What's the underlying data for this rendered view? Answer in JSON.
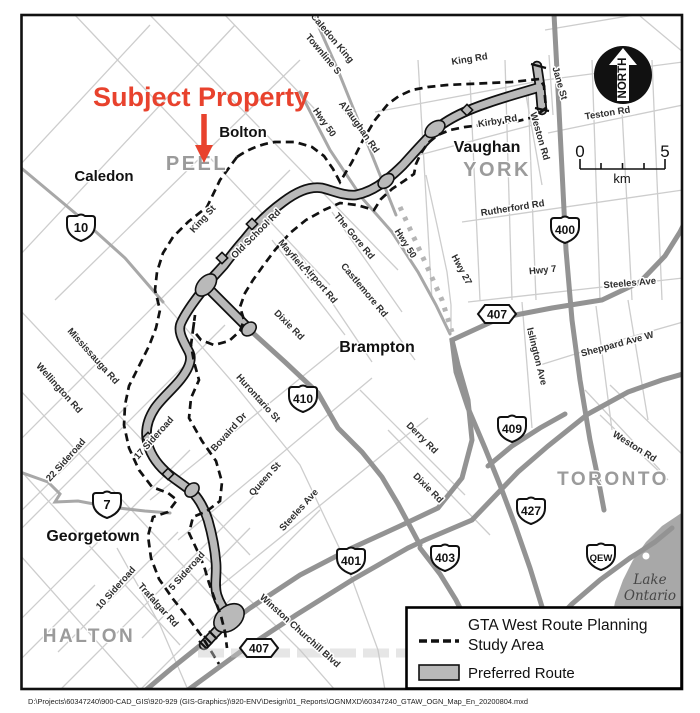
{
  "annotation": {
    "subject_property": "Subject Property",
    "color": "#e8422d"
  },
  "north_arrow": {
    "label": "NORTH"
  },
  "scale_bar": {
    "start": "0",
    "end": "5",
    "unit": "km"
  },
  "legend": {
    "study_area_line1": "GTA West Route Planning",
    "study_area_line2": "Study Area",
    "preferred_route": "Preferred Route"
  },
  "water": {
    "line1": "Lake",
    "line2": "Ontario"
  },
  "file_path": "D:\\Projects\\60347240\\900-CAD_GIS\\920-929 (GIS-Graphics)\\920-ENV\\Design\\01_Reports\\OGNMXD\\60347240_GTAW_OGN_Map_En_20200804.mxd",
  "regions": [
    {
      "name": "PEEL",
      "x": 197,
      "y": 170,
      "size": 20
    },
    {
      "name": "YORK",
      "x": 497,
      "y": 176,
      "size": 20
    },
    {
      "name": "TORONTO",
      "x": 613,
      "y": 485,
      "size": 19
    },
    {
      "name": "HALTON",
      "x": 89,
      "y": 642,
      "size": 19
    }
  ],
  "cities": [
    {
      "name": "Caledon",
      "x": 104,
      "y": 181,
      "size": 15
    },
    {
      "name": "Bolton",
      "x": 243,
      "y": 137,
      "size": 15
    },
    {
      "name": "Vaughan",
      "x": 487,
      "y": 152,
      "size": 16
    },
    {
      "name": "Brampton",
      "x": 377,
      "y": 352,
      "size": 16
    },
    {
      "name": "Georgetown",
      "x": 93,
      "y": 541,
      "size": 16
    }
  ],
  "road_labels": [
    {
      "t": "Caledon King",
      "x": 330,
      "y": 40,
      "r": 50
    },
    {
      "t": "Townline S",
      "x": 321,
      "y": 56,
      "r": 50
    },
    {
      "t": "Hwy 50",
      "x": 322,
      "y": 124,
      "r": 55
    },
    {
      "t": "Albion",
      "x": 347,
      "y": 116,
      "r": 55
    },
    {
      "t": "Vaughan Rd",
      "x": 359,
      "y": 131,
      "r": 55
    },
    {
      "t": "King Rd",
      "x": 470,
      "y": 62,
      "r": -9
    },
    {
      "t": "Jane St",
      "x": 557,
      "y": 84,
      "r": 74
    },
    {
      "t": "Weston Rd",
      "x": 537,
      "y": 137,
      "r": 74
    },
    {
      "t": "Teston Rd",
      "x": 608,
      "y": 116,
      "r": -9
    },
    {
      "t": "Kirby Rd",
      "x": 498,
      "y": 124,
      "r": -9
    },
    {
      "t": "Rutherford Rd",
      "x": 513,
      "y": 211,
      "r": -9
    },
    {
      "t": "Hwy 7",
      "x": 543,
      "y": 273,
      "r": -6
    },
    {
      "t": "Steeles Ave",
      "x": 630,
      "y": 286,
      "r": -5
    },
    {
      "t": "Sheppard Ave W",
      "x": 618,
      "y": 347,
      "r": -15
    },
    {
      "t": "Islington Ave",
      "x": 534,
      "y": 357,
      "r": 76
    },
    {
      "t": "Weston Rd",
      "x": 633,
      "y": 449,
      "r": 32
    },
    {
      "t": "Hwy 27",
      "x": 459,
      "y": 271,
      "r": 62
    },
    {
      "t": "Hwy 50",
      "x": 403,
      "y": 245,
      "r": 58
    },
    {
      "t": "King St",
      "x": 205,
      "y": 221,
      "r": -48
    },
    {
      "t": "Old School Rd",
      "x": 258,
      "y": 236,
      "r": -45
    },
    {
      "t": "The Gore Rd",
      "x": 352,
      "y": 238,
      "r": 50
    },
    {
      "t": "Mayfield Rd",
      "x": 295,
      "y": 263,
      "r": 50
    },
    {
      "t": "Airport Rd",
      "x": 318,
      "y": 286,
      "r": 50
    },
    {
      "t": "Castlemore Rd",
      "x": 362,
      "y": 292,
      "r": 50
    },
    {
      "t": "Dixie Rd",
      "x": 287,
      "y": 327,
      "r": 45
    },
    {
      "t": "Hurontario St",
      "x": 256,
      "y": 400,
      "r": 48
    },
    {
      "t": "Mississauga Rd",
      "x": 91,
      "y": 358,
      "r": 48
    },
    {
      "t": "Wellington Rd",
      "x": 57,
      "y": 390,
      "r": 48
    },
    {
      "t": "Bovaird Dr",
      "x": 231,
      "y": 434,
      "r": -48
    },
    {
      "t": "Queen St",
      "x": 267,
      "y": 481,
      "r": -48
    },
    {
      "t": "Steeles Ave",
      "x": 301,
      "y": 512,
      "r": -48
    },
    {
      "t": "22 Sideroad",
      "x": 68,
      "y": 462,
      "r": -48
    },
    {
      "t": "17 Sideroad",
      "x": 156,
      "y": 440,
      "r": -48
    },
    {
      "t": "10 Sideroad",
      "x": 118,
      "y": 590,
      "r": -48
    },
    {
      "t": "5 Sideroad",
      "x": 189,
      "y": 573,
      "r": -48
    },
    {
      "t": "Trafalgar Rd",
      "x": 156,
      "y": 607,
      "r": 48
    },
    {
      "t": "Winston Churchill Blvd",
      "x": 298,
      "y": 633,
      "r": 42
    },
    {
      "t": "Derry Rd",
      "x": 420,
      "y": 440,
      "r": 45
    },
    {
      "t": "Dixie Rd",
      "x": 426,
      "y": 490,
      "r": 45
    }
  ],
  "shields": [
    {
      "v": "10",
      "x": 81,
      "y": 228,
      "t": "crown"
    },
    {
      "v": "7",
      "x": 107,
      "y": 505,
      "t": "crown"
    },
    {
      "v": "410",
      "x": 303,
      "y": 399,
      "t": "crown"
    },
    {
      "v": "400",
      "x": 565,
      "y": 230,
      "t": "crown"
    },
    {
      "v": "401",
      "x": 351,
      "y": 561,
      "t": "crown"
    },
    {
      "v": "403",
      "x": 445,
      "y": 558,
      "t": "crown"
    },
    {
      "v": "427",
      "x": 531,
      "y": 511,
      "t": "crown"
    },
    {
      "v": "409",
      "x": 512,
      "y": 429,
      "t": "crown"
    },
    {
      "v": "QEW",
      "x": 601,
      "y": 557,
      "t": "crown",
      "f": 9.5
    },
    {
      "v": "407",
      "x": 259,
      "y": 648,
      "t": "hex"
    },
    {
      "v": "407",
      "x": 497,
      "y": 314,
      "t": "hex"
    }
  ],
  "colors": {
    "thin_road": "#cdcdcd",
    "medium_road": "#a8a8a8",
    "thick_road": "#939393",
    "corridor_fill": "#b9b9b9",
    "boundary": "#111111",
    "water": "#a8a8a8",
    "annotation_red": "#e8422d"
  }
}
